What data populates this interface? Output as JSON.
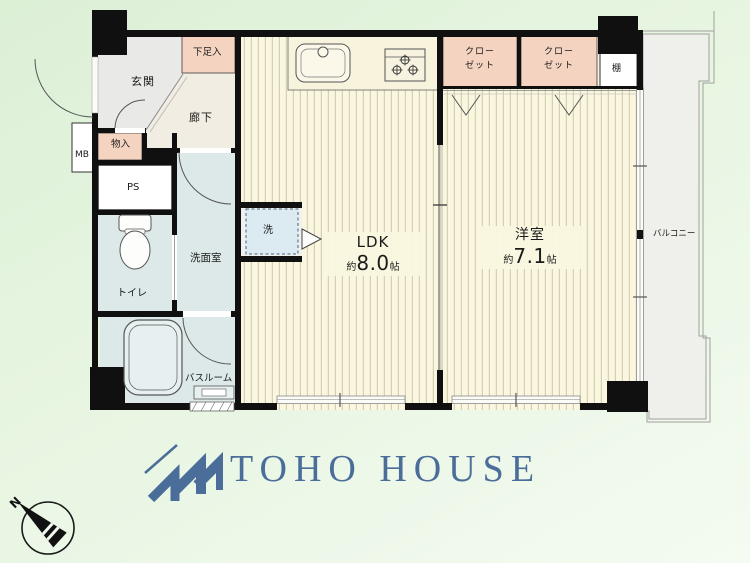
{
  "plan": {
    "genkan": "玄関",
    "shoe_box": "下足入",
    "hallway": "廊下",
    "storage": "物入",
    "meter_box": "MB",
    "pipe_space": "PS",
    "toilet": "トイレ",
    "washroom": "洗面室",
    "bathroom": "バスルーム",
    "washer": "洗",
    "shelf": "棚",
    "balcony": "バルコニー",
    "ldk": {
      "name": "LDK",
      "area_prefix": "約",
      "area_value": "8.0",
      "area_unit": "帖"
    },
    "western_room": {
      "name": "洋室",
      "area_prefix": "約",
      "area_value": "7.1",
      "area_unit": "帖"
    },
    "closet_left": {
      "line1": "クロー",
      "line2": "ゼット"
    },
    "closet_right": {
      "line1": "クロー",
      "line2": "ゼット"
    }
  },
  "compass": {
    "north": "N"
  },
  "brand": {
    "name": "TOHO HOUSE"
  },
  "colors": {
    "background_green": "#e7f5e1",
    "wall": "#101010",
    "closet_fill": "#f4d4c0",
    "wet_room_fill": "#dde9e9",
    "floor_base": "#faf6df",
    "hallway_fill": "#f2ede2",
    "genkan_fill": "#e9e9e7",
    "balcony_fill": "#efefeb",
    "logo_blue": "#4a6d99"
  }
}
